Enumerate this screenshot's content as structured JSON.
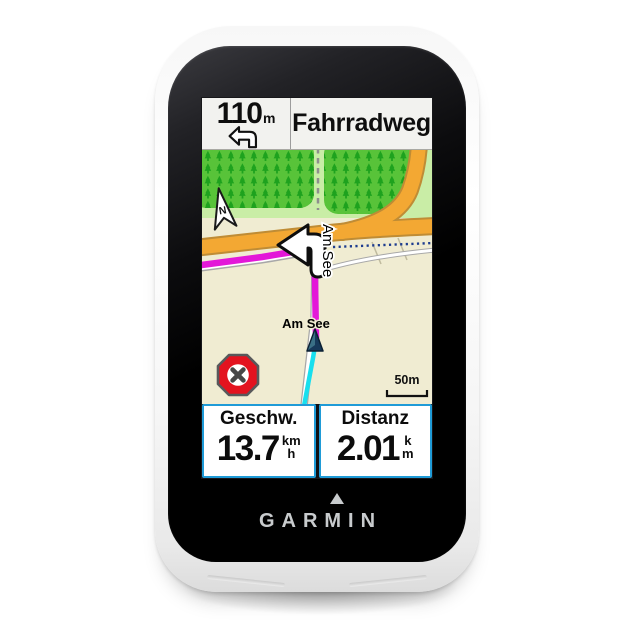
{
  "device": {
    "brand": "GARMIN"
  },
  "navigation_bar": {
    "distance_value": "110",
    "distance_unit": "m",
    "street_name": "Fahrradweg"
  },
  "map": {
    "labels": {
      "street_vertical": "Am See",
      "street_horizontal": "Am See",
      "north": "N",
      "scale": "50m"
    }
  },
  "data_fields": [
    {
      "label": "Geschw.",
      "value": "13.7",
      "unit_top": "km",
      "unit_bottom": "h"
    },
    {
      "label": "Distanz",
      "value": "2.01",
      "unit_top": "k",
      "unit_bottom": "m"
    }
  ],
  "icons": {
    "turn_indicator": "turn-left-arrow-icon",
    "maneuver_overlay": "turn-left-maneuver-icon",
    "north": "north-arrow-icon",
    "position": "position-marker-icon",
    "stop": "stop-route-icon",
    "brand_mark": "garmin-delta-icon"
  },
  "colors": {
    "route": "#E318D8",
    "track": "#18DFEE",
    "major_road": "#F3A833",
    "forest": "#58C339",
    "forest_light": "#C9EDA6",
    "map_background": "#F0ECD2",
    "field_border": "#1F9BD7",
    "stop_button": "#E3131F",
    "position_marker": "#17395A",
    "boundary_dots": "#1D3C8F"
  }
}
